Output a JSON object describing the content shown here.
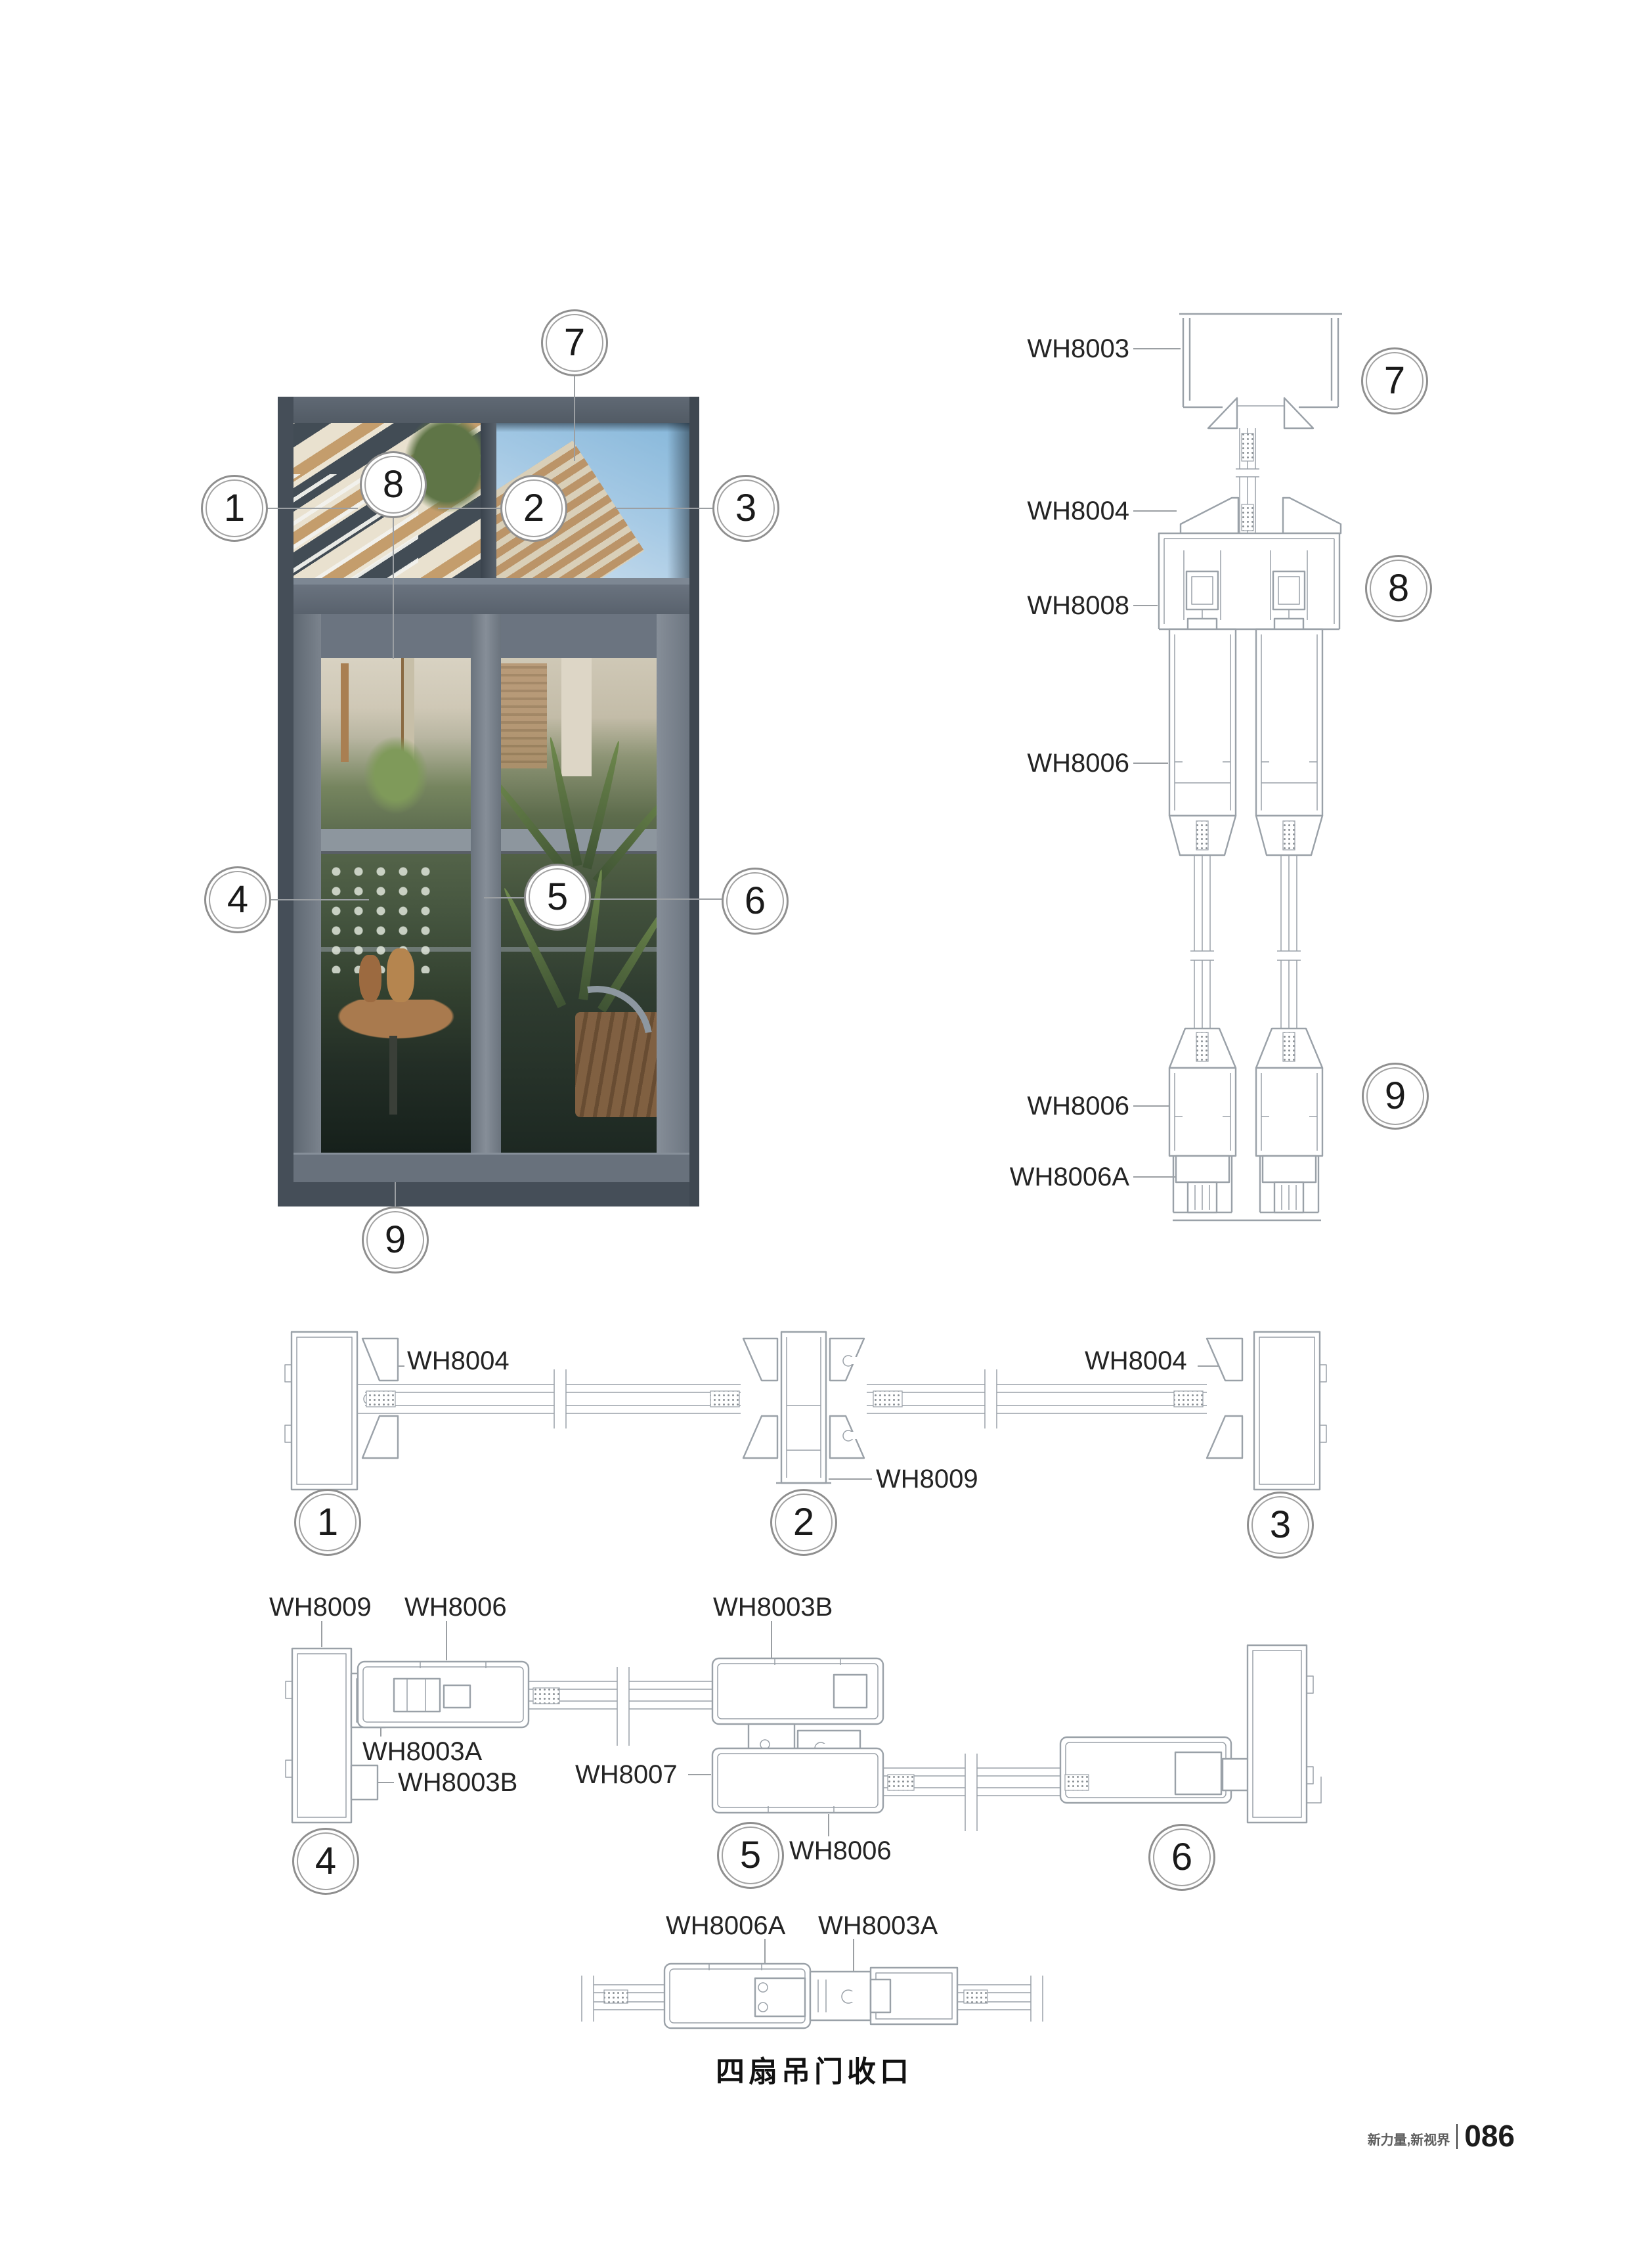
{
  "callouts": {
    "n1": "1",
    "n2": "2",
    "n3": "3",
    "n4": "4",
    "n5": "5",
    "n6": "6",
    "n7": "7",
    "n8": "8",
    "n9": "9"
  },
  "vertical_section": {
    "labels": [
      "WH8003",
      "WH8004",
      "WH8008",
      "WH8006",
      "WH8006",
      "WH8006A"
    ]
  },
  "row1": {
    "labels": [
      "WH8004",
      "WH8009",
      "WH8004"
    ]
  },
  "row2": {
    "labels": [
      "WH8009",
      "WH8006",
      "WH8003B",
      "WH8003A",
      "WH8003B",
      "WH8007",
      "WH8006"
    ]
  },
  "row3": {
    "labels": [
      "WH8006A",
      "WH8003A"
    ],
    "caption": "四扇吊门收口"
  },
  "footer": {
    "slogan": "新力量,新视界",
    "page_number": "086"
  },
  "colors": {
    "profile_line": "#9aa1a8",
    "leader_line": "#9b9fa3",
    "frame_gray": "#525b65",
    "sky_blue": "#9cc3e2"
  }
}
